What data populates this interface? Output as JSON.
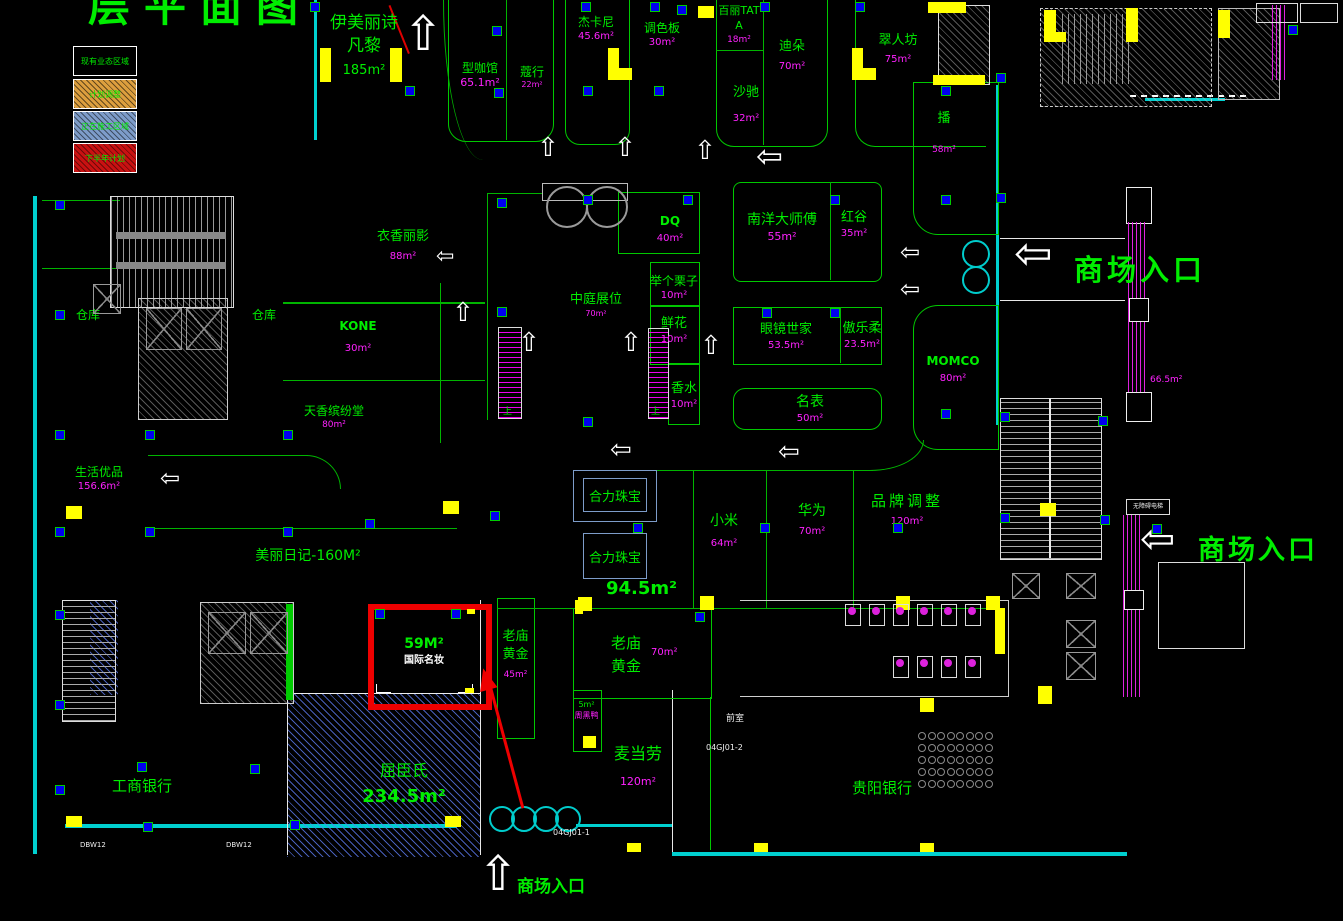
{
  "title": "层平面图",
  "legend": {
    "items": [
      {
        "label": "现有业态区域"
      },
      {
        "label": "计划调整"
      },
      {
        "label": "正在施工区域"
      },
      {
        "label": "下半年计划"
      }
    ]
  },
  "colors": {
    "store_name": "#00ee00",
    "area_text": "#ff22ff",
    "highlight_box": "#ff0000",
    "column": "#0000ee",
    "wall": "#00d0d0",
    "accent": "#ffff00"
  },
  "entrances": {
    "right_upper": "商场入口",
    "right_lower": "商场入口",
    "bottom": "商场入口"
  },
  "stores": {
    "yimeili": {
      "name": "伊美丽诗凡黎",
      "area": "185m²"
    },
    "xingkaguan": {
      "name": "型咖馆",
      "area": "65.1m²"
    },
    "kouhang": {
      "name": "蔻行",
      "area": "22m²"
    },
    "jiekani": {
      "name": "杰卡尼",
      "area": "45.6m²"
    },
    "tiaoseban": {
      "name": "调色板",
      "area": "30m²"
    },
    "bailitata": {
      "name": "百丽TATA",
      "area": "18m²"
    },
    "diduo": {
      "name": "迪朵",
      "area": "70m²"
    },
    "shachi": {
      "name": "沙驰",
      "area": "32m²"
    },
    "cuirenfang": {
      "name": "翠人坊",
      "area": "75m²"
    },
    "bo": {
      "name": "播",
      "area": "58m²"
    },
    "yixiang": {
      "name": "衣香丽影",
      "area": "88m²"
    },
    "kone": {
      "name": "KONE",
      "area": "30m²"
    },
    "tianxiang": {
      "name": "天香缤纷堂",
      "area": "80m²"
    },
    "cangku1": {
      "name": "仓库"
    },
    "cangku2": {
      "name": "仓库"
    },
    "shenghuo": {
      "name": "生活优品",
      "area": "156.6m²"
    },
    "dq": {
      "name": "DQ",
      "area": "40m²"
    },
    "zhongting": {
      "name": "中庭展位",
      "area": "70m²"
    },
    "juge": {
      "name": "举个栗子",
      "area": "10m²"
    },
    "xianhua": {
      "name": "鲜花",
      "area": "10m²"
    },
    "xiangshui": {
      "name": "香水",
      "area": "10m²"
    },
    "nanyang": {
      "name": "南洋大师傅",
      "area": "55m²"
    },
    "honggu": {
      "name": "红谷",
      "area": "35m²"
    },
    "yanjing": {
      "name": "眼镜世家",
      "area": "53.5m²"
    },
    "aolerou": {
      "name": "傲乐柔",
      "area": "23.5m²"
    },
    "mingbiao": {
      "name": "名表",
      "area": "50m²"
    },
    "momco": {
      "name": "MOMCO",
      "area": "80m²"
    },
    "heli1": {
      "name": "合力珠宝"
    },
    "heli2": {
      "name": "合力珠宝",
      "area": "94.5m²"
    },
    "xiaomi": {
      "name": "小米",
      "area": "64m²"
    },
    "huawei": {
      "name": "华为",
      "area": "70m²"
    },
    "pinpai": {
      "name": "品牌调整",
      "area": "120m²"
    },
    "meili": {
      "name": "美丽日记-160M²"
    },
    "highlight": {
      "area": "59M²",
      "name": "国际名妆"
    },
    "laomiao1": {
      "name": "老庙黄金",
      "area": "45m²"
    },
    "laomiao2": {
      "name": "老庙黄金",
      "area": "70m²"
    },
    "zhouheiya": {
      "area": "5m²",
      "name": "周黑鸭"
    },
    "maidanglao": {
      "name": "麦当劳",
      "area": "120m²"
    },
    "guiyang": {
      "name": "贵阳银行"
    },
    "gongshang": {
      "name": "工商银行"
    },
    "quchenshi": {
      "name": "屈臣氏",
      "area": "234.5m²"
    }
  },
  "labels": {
    "qianshi": "前室",
    "up1": "上",
    "up2": "上",
    "travelator_area": "66.5m²",
    "accessible_lift": "无障碍电梯",
    "code1": "04GJ01-1",
    "code2": "04GJ01-2",
    "dbw1": "DBW12",
    "dbw2": "DBW12"
  }
}
